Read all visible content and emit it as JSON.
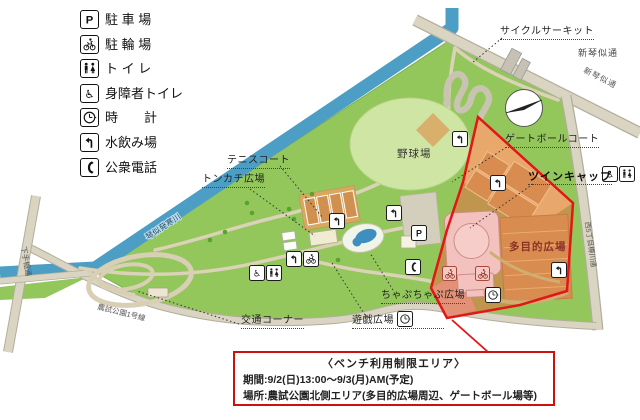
{
  "legend": {
    "items": [
      {
        "icon": "parking-icon",
        "label": "駐 車 場"
      },
      {
        "icon": "bicycle-parking-icon",
        "label": "駐 輪 場"
      },
      {
        "icon": "toilet-icon",
        "label": "ト イ レ"
      },
      {
        "icon": "accessible-toilet-icon",
        "label": "身障者トイレ"
      },
      {
        "icon": "clock-icon",
        "label": "時　　計"
      },
      {
        "icon": "drinking-fountain-icon",
        "label": "水飲み場"
      },
      {
        "icon": "public-phone-icon",
        "label": "公衆電話"
      }
    ]
  },
  "map": {
    "facility_labels": {
      "cycle_circuit": "サイクルサーキット",
      "gateball_court": "ゲートボールコート",
      "twin_cap": "ツインキャップ",
      "multipurpose_plaza": "多目的広場",
      "baseball_field": "野球場",
      "tennis_court": "テニスコート",
      "tonkachi_plaza": "トンカチ広場",
      "chapuchapu_plaza": "ちゃぷちゃぷ広場",
      "play_plaza": "遊戯広場",
      "traffic_corner": "交通コーナー"
    },
    "road_labels": {
      "shinkotoni_street": "新琴似通",
      "shinkotoni_street_on_road": "新琴似通",
      "east_street": "西5丁目樽川通",
      "west_street": "下手稲通",
      "south_street": "農試公園1号線",
      "river": "琴似発寒川"
    }
  },
  "notice": {
    "title": "〈ベンチ利用制限エリア〉",
    "period": "期間:9/2(日)13:00～9/3(月)AM(予定)",
    "place": "場所:農試公園北側エリア(多目的広場周辺、ゲートボール場等)"
  },
  "colors": {
    "restricted_border": "#e11717",
    "park_green": "#93c75c",
    "river_blue": "#4d9ec5",
    "court_orange": "#d98c4f",
    "building_pink": "#f3c1be",
    "notice_border": "#cc1111"
  }
}
